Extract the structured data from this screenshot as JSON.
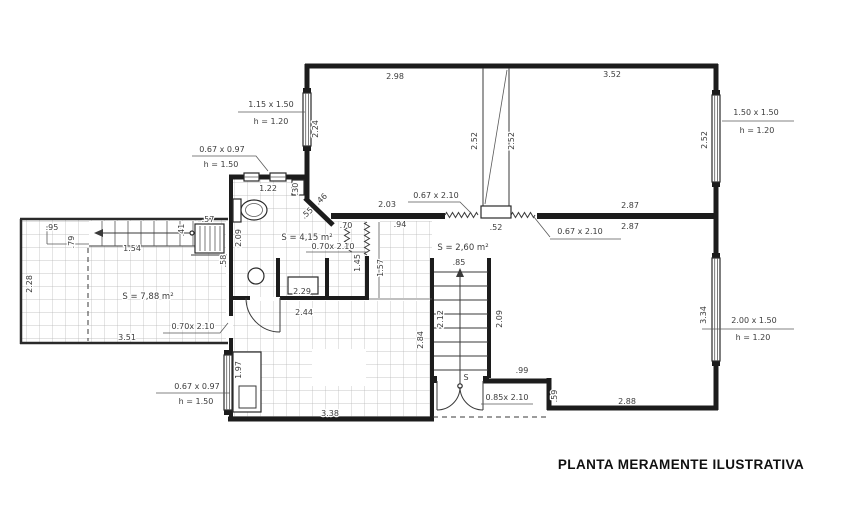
{
  "title": "PLANTA MERAMENTE ILUSTRATIVA",
  "areas": {
    "terrace": "S = 7,88 m²",
    "bathroom": "S = 4,15 m²",
    "stair_hall": "S = 2,60 m²"
  },
  "windows": {
    "left_bedroom": {
      "size": "1.15 x 1.50",
      "sill": "h = 1.20"
    },
    "right_bedroom": {
      "size": "1.50 x 1.50",
      "sill": "h = 1.20"
    },
    "bathroom": {
      "size": "0.67 x 0.97",
      "sill": "h = 1.50"
    },
    "kitchen": {
      "size": "0.67 x 0.97",
      "sill": "h = 1.50"
    },
    "living_room": {
      "size": "2.00 x 1.50",
      "sill": "h = 1.20"
    }
  },
  "doors": {
    "hall_left": "0.67 x 2.10",
    "hall_right": "0.67 x 2.10",
    "bathroom": "0.70x 2.10",
    "terrace": "0.70x 2.10",
    "entry": "0.85x 2.10",
    "entry_swing_tag": "S"
  },
  "dimensions": {
    "bedroom1_width": "2.98",
    "bedroom1_height": "2.24",
    "shaft_left": "2.52",
    "shaft_right": "2.52",
    "bedroom2_width": "3.52",
    "bedroom2_height": "2.52",
    "bedroom2_bottom_a": "2.87",
    "bedroom2_bottom_b": "2.87",
    "hall_top": "2.03",
    "hall_width": ".94",
    "column_width": ".52",
    "bath_window_span": "1.22",
    "bath_niche": ".30",
    "bath_height": "2.09",
    "bath_door_width": ".70",
    "chamfer_a": ".46",
    "chamfer_b": ".55",
    "bath_partition": "1.45",
    "hall_height": "1.57",
    "tub_span": "2.29",
    "bath_width": "2.44",
    "stair_width": ".85",
    "stair_left": "2.12",
    "stair_right": "2.09",
    "terrace_top": ".95",
    "terrace_step": ".79",
    "terrace_stair": "1.54",
    "terrace_left": "2.28",
    "radiator_step": ".41",
    "radiator_width": ".57",
    "radiator_height": ".58",
    "terrace_bottom": "3.51",
    "counter_height": "1.97",
    "kitchen_right": "2.84",
    "kitchen_bottom": "3.38",
    "entry_step": ".99",
    "entry_side": ".59",
    "living_bottom": "2.88",
    "living_window": "3.34"
  },
  "colors": {
    "ink": "#1c1c1c",
    "grid": "#b5b5b5",
    "background": "#ffffff"
  }
}
